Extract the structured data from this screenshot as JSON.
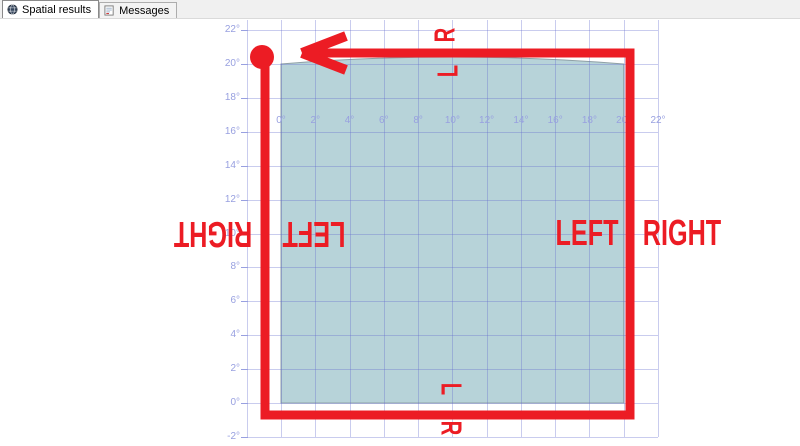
{
  "tabs": [
    {
      "label": "Spatial results",
      "icon": "globe-icon",
      "active": true
    },
    {
      "label": "Messages",
      "icon": "messages-icon",
      "active": false
    }
  ],
  "plot": {
    "x_axis": {
      "labels": [
        "0°",
        "2°",
        "4°",
        "6°",
        "8°",
        "10°",
        "12°",
        "14°",
        "16°",
        "18°",
        "20°",
        "22°"
      ],
      "first_value": 0,
      "step": 2
    },
    "y_axis": {
      "labels": [
        "22°",
        "20°",
        "18°",
        "16°",
        "14°",
        "12°",
        "10°",
        "8°",
        "6°",
        "4°",
        "2°",
        "0°",
        "-2°"
      ],
      "first_value": 22,
      "step": -2
    },
    "colors": {
      "grid": "rgba(100,110,205,0.35)",
      "axis_text": "#98a0e0",
      "polygon_fill": "#b7d3d9",
      "polygon_stroke": "#8fa0a6",
      "background": "#ffffff"
    },
    "geometry": {
      "origin_x": 281,
      "origin_y": 403,
      "px_per_unit_x": 17.136,
      "px_per_unit_y": 16.95,
      "grid_min": -2,
      "grid_max": 22,
      "grid_top": 20,
      "grid_bottom": 437,
      "grid_left": 246,
      "grid_right": 658,
      "x_label_row_y": 115,
      "y_label_right_x": 240,
      "y_tick_x": 241
    },
    "polygon": {
      "x_min": 0,
      "x_max": 20,
      "y_min": 0,
      "y_max": 20,
      "top_arc_bulge_px": 14
    }
  },
  "annotations": {
    "color": "#ec1c24",
    "square": {
      "left": 265,
      "top": 53,
      "right": 630,
      "bottom": 415,
      "stroke_width": 9
    },
    "dot": {
      "cx": 262,
      "cy": 57,
      "r": 12
    },
    "arrow": {
      "tip_x": 302,
      "tip_y": 53,
      "barb1_x": 346,
      "barb1_y": 36,
      "barb2_x": 346,
      "barb2_y": 70,
      "shaft_start_x": 314,
      "stroke_width": 10
    },
    "labels": [
      {
        "text": "R",
        "x": 446,
        "y": 35,
        "rotate": -90,
        "font_size": 29
      },
      {
        "text": "L",
        "x": 449,
        "y": 71,
        "rotate": -90,
        "font_size": 29
      },
      {
        "text": "RIGHT",
        "x": 213,
        "y": 234,
        "rotate": 180,
        "font_size": 36
      },
      {
        "text": "LEFT",
        "x": 314,
        "y": 234,
        "rotate": 180,
        "font_size": 36
      },
      {
        "text": "LEFT",
        "x": 587,
        "y": 233,
        "rotate": 0,
        "font_size": 36
      },
      {
        "text": "RIGHT",
        "x": 682,
        "y": 233,
        "rotate": 0,
        "font_size": 36
      },
      {
        "text": "L",
        "x": 450,
        "y": 389,
        "rotate": 90,
        "font_size": 29
      },
      {
        "text": "R",
        "x": 450,
        "y": 428,
        "rotate": 90,
        "font_size": 29
      }
    ]
  },
  "chart_data": {
    "type": "area",
    "x_ticks": [
      0,
      2,
      4,
      6,
      8,
      10,
      12,
      14,
      16,
      18,
      20,
      22
    ],
    "y_ticks": [
      22,
      20,
      18,
      16,
      14,
      12,
      10,
      8,
      6,
      4,
      2,
      0,
      -2
    ],
    "tick_unit": "°",
    "grid": true,
    "polygon_extent": {
      "x_min": 0,
      "x_max": 20,
      "y_min": 0,
      "y_max": 20
    },
    "overlay_path": {
      "shape": "square",
      "direction": "counterclockwise",
      "start_marker_at": [
        0,
        20
      ],
      "arrow_points": "left",
      "side_labels": [
        "L",
        "R",
        "LEFT",
        "RIGHT"
      ]
    }
  }
}
